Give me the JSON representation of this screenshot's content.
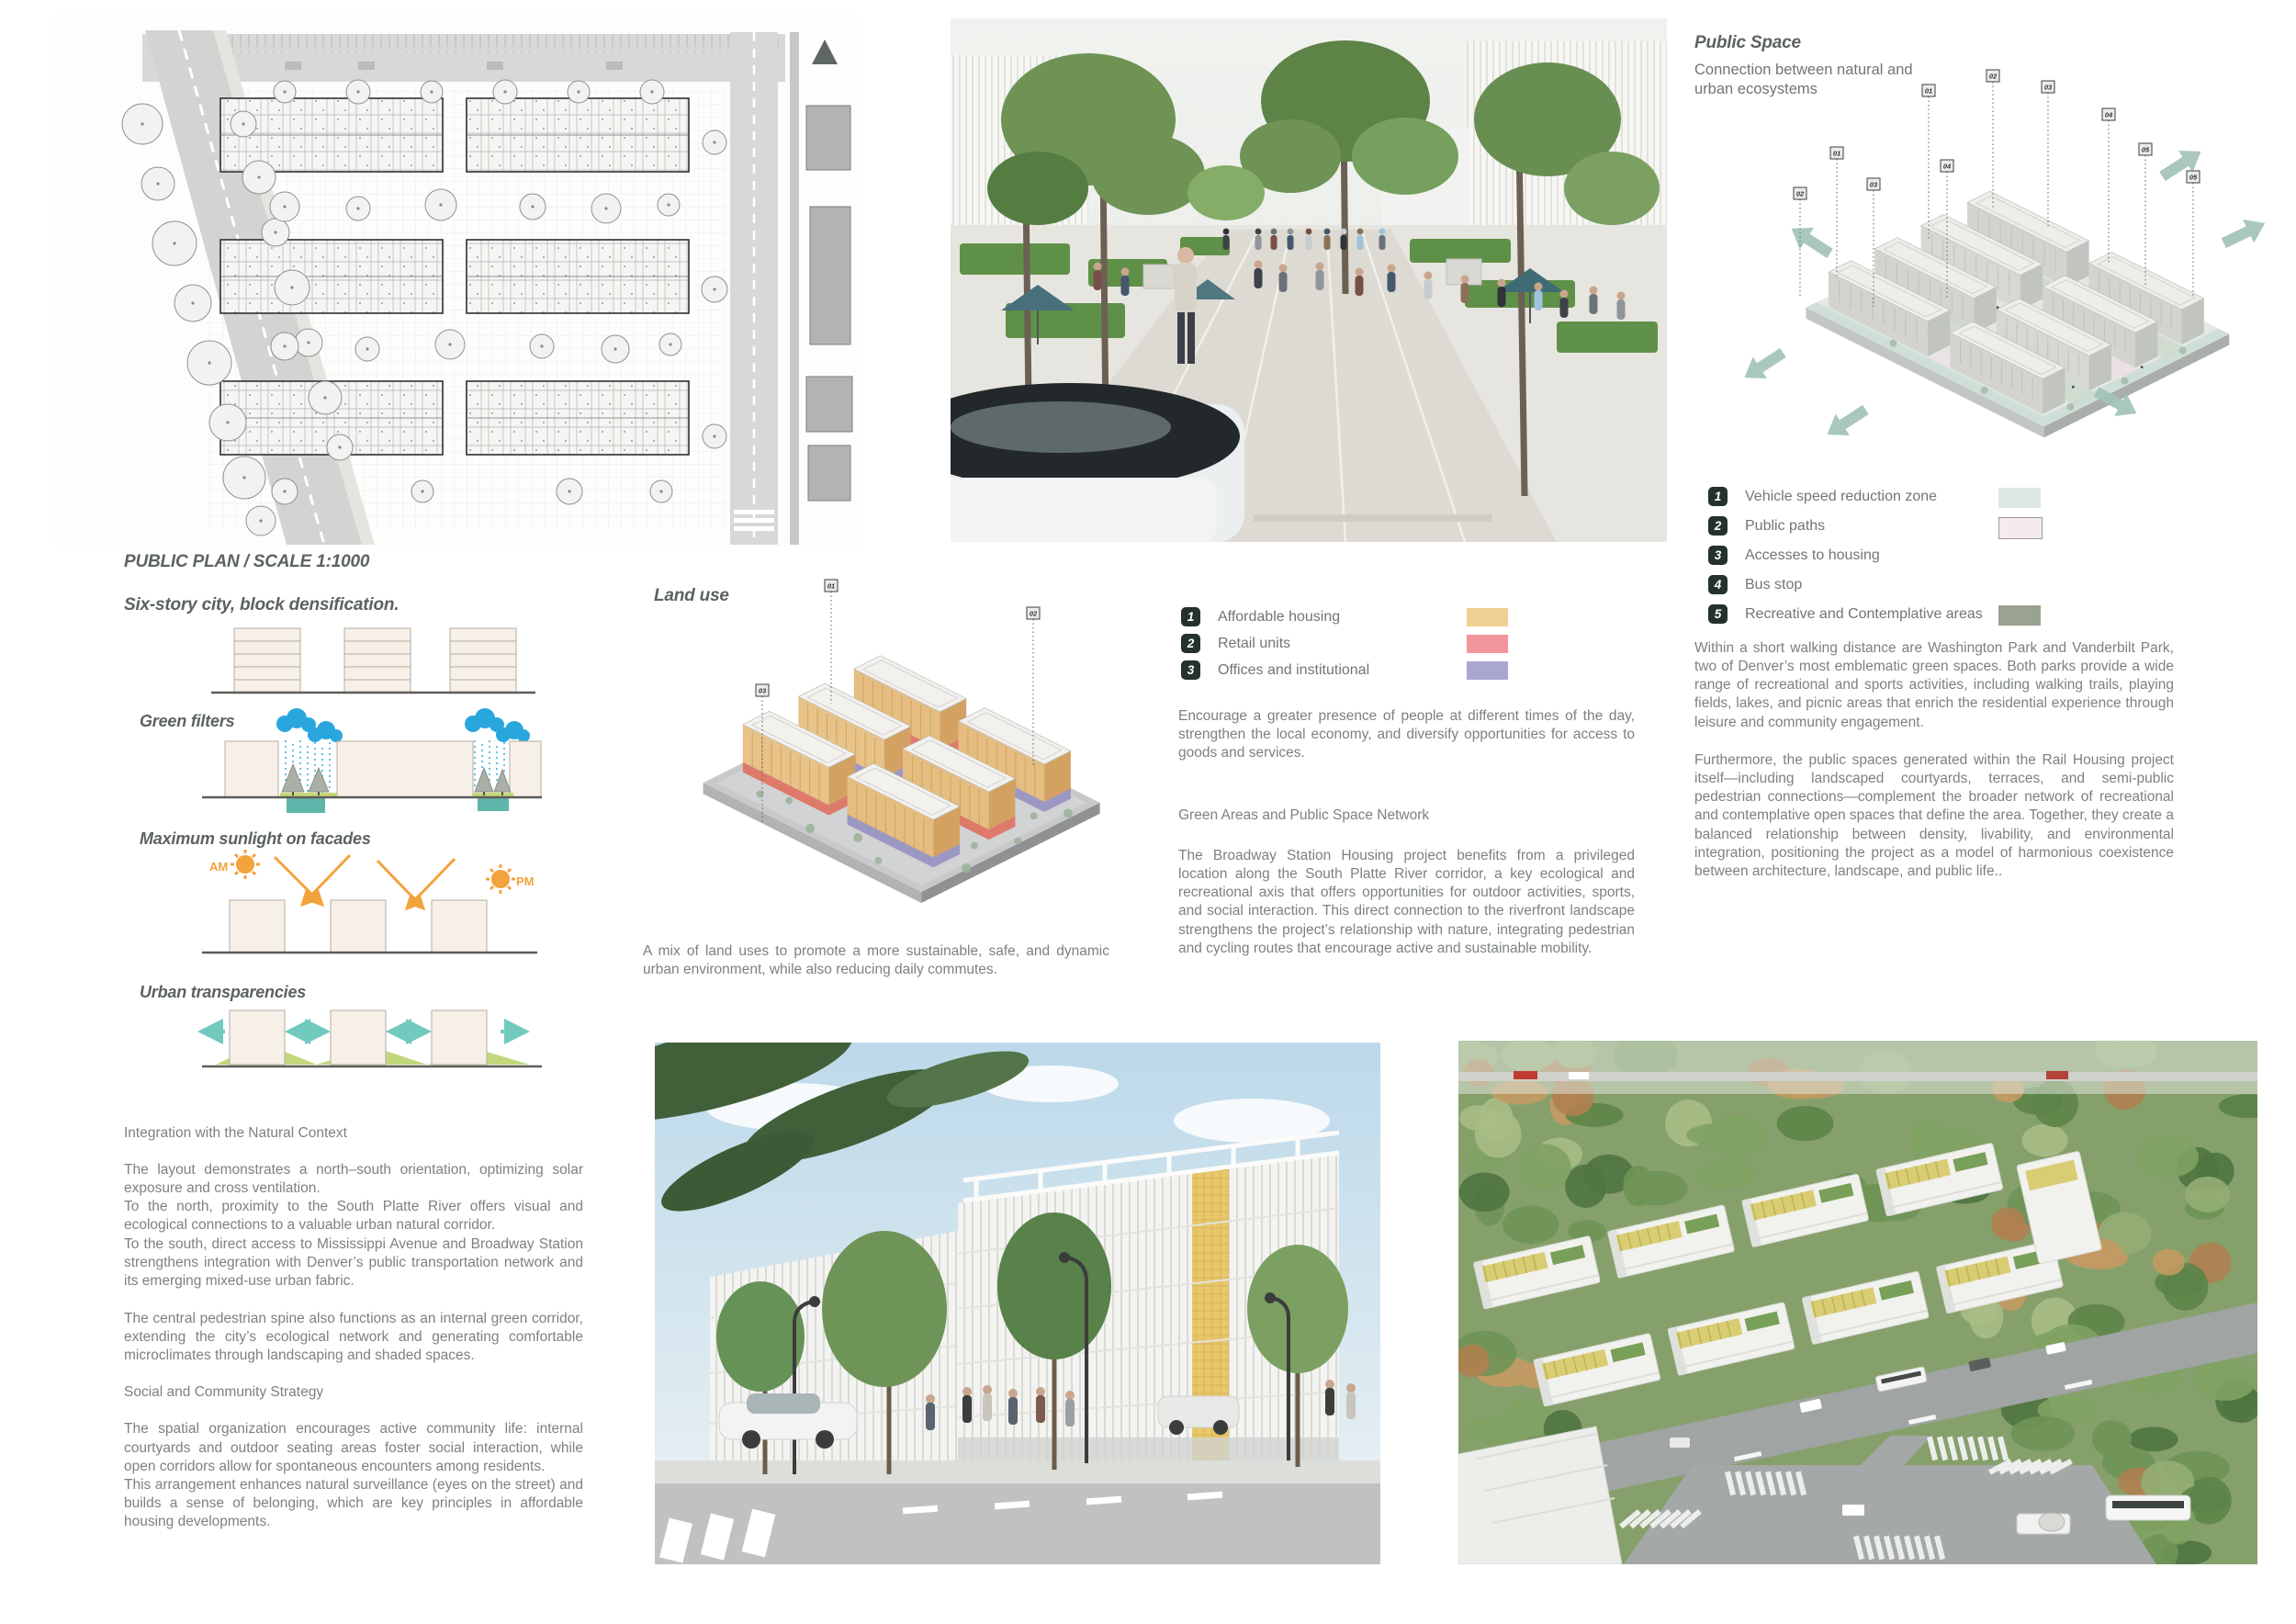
{
  "plan": {
    "caption": "PUBLIC PLAN / SCALE 1:1000"
  },
  "diagrams": {
    "densification_title": "Six-story city, block densification.",
    "green_filters_title": "Green filters",
    "sunlight_title": "Maximum sunlight on facades",
    "sunlight_am": "AM",
    "sunlight_pm": "PM",
    "transparencies_title": "Urban transparencies"
  },
  "left_text": {
    "heading1": "Integration with the Natural Context",
    "para1": "The layout demonstrates a north–south orientation, optimizing solar exposure and cross ventilation.",
    "para2": "To the north, proximity to the South Platte River offers visual and ecological connections to a valuable urban natural corridor.",
    "para3": "To the south, direct access to Mississippi Avenue and Broadway Station strengthens integration with Denver’s public transportation network and its emerging mixed-use urban fabric.",
    "para4": "The central pedestrian spine also functions as an internal green corridor, extending the city’s ecological network and generating comfortable microclimates through landscaping and shaded spaces.",
    "heading2": "Social and Community Strategy",
    "para5": "The spatial organization encourages active community life: internal courtyards and outdoor seating areas foster social interaction, while open corridors allow for spontaneous encounters among residents.",
    "para6": "This arrangement enhances natural surveillance (eyes on the street) and builds a sense of belonging, which are key principles in affordable housing developments."
  },
  "land_use": {
    "title": "Land use",
    "legend": [
      {
        "num": "1",
        "label": "Affordable housing",
        "color": "#f0cf92"
      },
      {
        "num": "2",
        "label": "Retail units",
        "color": "#f2949c"
      },
      {
        "num": "3",
        "label": "Offices and institutional",
        "color": "#aaa6d2"
      }
    ],
    "callouts": [
      "01",
      "02",
      "03"
    ],
    "caption": "A mix of land uses to promote a more sustainable, safe, and dynamic urban environment, while also reducing daily commutes."
  },
  "center_text": {
    "para1": "Encourage a greater presence of people at different times of the day, strengthen the local economy, and diversify opportunities for access to goods and services.",
    "heading": "Green Areas and Public Space Network",
    "para2": "The Broadway Station Housing project benefits from a privileged location along the South Platte River corridor, a key ecological and recreational axis that offers opportunities for outdoor activities, sports, and social interaction. This direct connection to the riverfront landscape strengthens the project’s relationship with nature, integrating pedestrian and cycling routes that encourage active and sustainable mobility."
  },
  "public_space": {
    "title": "Public Space",
    "subtitle": "Connection between natural and urban ecosystems",
    "callouts": [
      "01",
      "02",
      "03",
      "04",
      "05"
    ],
    "legend": [
      {
        "num": "1",
        "label": "Vehicle speed reduction zone",
        "color": "#dde8e2"
      },
      {
        "num": "2",
        "label": "Public paths",
        "color": "#f5ebee"
      },
      {
        "num": "3",
        "label": "Accesses to housing",
        "color": ""
      },
      {
        "num": "4",
        "label": "Bus stop",
        "color": ""
      },
      {
        "num": "5",
        "label": "Recreative and Contemplative areas",
        "color": "#9aa392"
      }
    ],
    "para1": "Within a short walking distance are Washington Park and Vanderbilt Park, two of Denver’s most emblematic green spaces. Both parks provide a wide range of recreational and sports activities, including walking trails, playing fields, lakes, and picnic areas that enrich the residential experience through leisure and community engagement.",
    "para2": "Furthermore, the public spaces generated within the Rail Housing project itself—including landscaped courtyards, terraces, and semi-public pedestrian connections—complement the broader network of recreational and contemplative open spaces that define the area. Together, they create a balanced relationship between density, livability, and environmental integration, positioning the project as a model of harmonious coexistence between architecture, landscape, and public life.."
  }
}
